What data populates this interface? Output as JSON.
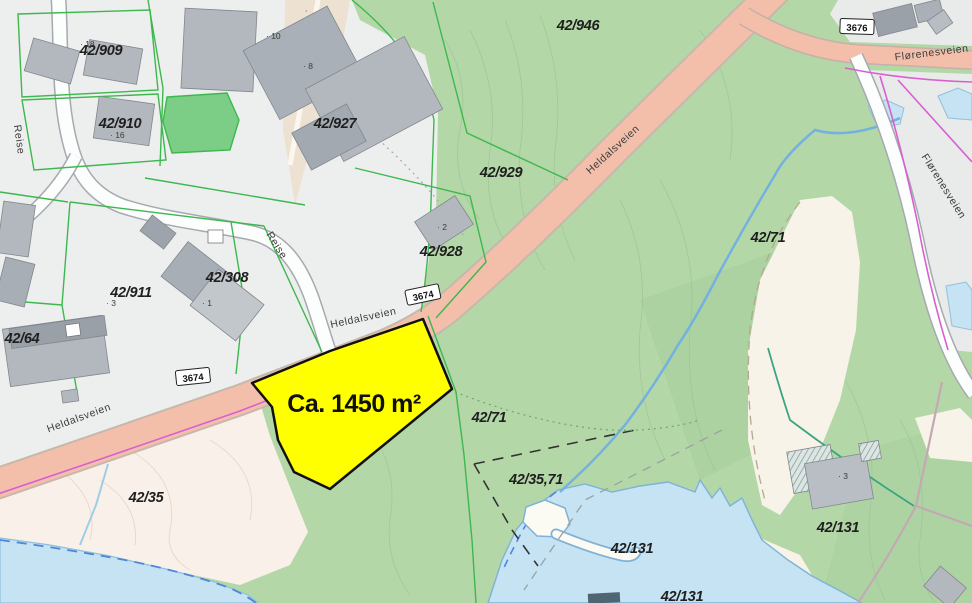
{
  "map": {
    "highlight": {
      "label": "Ca. 1450 m²",
      "color": "#ffff00"
    },
    "parcel_labels": [
      {
        "text": "42/909",
        "x": 101,
        "y": 55,
        "rot": 0
      },
      {
        "text": "42/910",
        "x": 120,
        "y": 128,
        "rot": 0
      },
      {
        "text": "42/927",
        "x": 335,
        "y": 128,
        "rot": 0
      },
      {
        "text": "42/946",
        "x": 578,
        "y": 30,
        "rot": 0
      },
      {
        "text": "42/929",
        "x": 501,
        "y": 177,
        "rot": 0
      },
      {
        "text": "42/928",
        "x": 441,
        "y": 256,
        "rot": 0
      },
      {
        "text": "42/308",
        "x": 227,
        "y": 282,
        "rot": 0
      },
      {
        "text": "42/911",
        "x": 131,
        "y": 297,
        "rot": 0
      },
      {
        "text": "42/64",
        "x": 22,
        "y": 343,
        "rot": 0
      },
      {
        "text": "42/71",
        "x": 768,
        "y": 242,
        "rot": 0
      },
      {
        "text": "42/71",
        "x": 489,
        "y": 422,
        "rot": 0
      },
      {
        "text": "42/35",
        "x": 146,
        "y": 502,
        "rot": 0
      },
      {
        "text": "42/35,71",
        "x": 536,
        "y": 484,
        "rot": 0
      },
      {
        "text": "42/131",
        "x": 632,
        "y": 553,
        "rot": 0
      },
      {
        "text": "42/131",
        "x": 682,
        "y": 601,
        "rot": 0
      },
      {
        "text": "42/131",
        "x": 838,
        "y": 532,
        "rot": 0
      }
    ],
    "road_labels": [
      {
        "text": "Heldalsveien",
        "x": 615,
        "y": 152,
        "rot": -42,
        "size": 10.5
      },
      {
        "text": "Heldalsveien",
        "x": 364,
        "y": 321,
        "rot": -12,
        "size": 10.5
      },
      {
        "text": "Heldalsveien",
        "x": 80,
        "y": 421,
        "rot": -20,
        "size": 10.5
      },
      {
        "text": "Flørenesveien",
        "x": 932,
        "y": 56,
        "rot": -7,
        "size": 10
      },
      {
        "text": "Flørenesveien",
        "x": 941,
        "y": 188,
        "rot": 58,
        "size": 10
      },
      {
        "text": "Reise",
        "x": 16,
        "y": 140,
        "rot": 82,
        "size": 9.5
      },
      {
        "text": "Reise",
        "x": 274,
        "y": 247,
        "rot": 58,
        "size": 9.5
      }
    ],
    "road_badges": [
      {
        "text": "3674",
        "x": 423,
        "y": 295,
        "rot": -12
      },
      {
        "text": "3674",
        "x": 193,
        "y": 377,
        "rot": -6
      },
      {
        "text": "3676",
        "x": 857,
        "y": 27,
        "rot": 2
      }
    ],
    "house_numbers": [
      {
        "text": "· 18",
        "x": 80,
        "y": 47
      },
      {
        "text": "· 16",
        "x": 110,
        "y": 138
      },
      {
        "text": "· 10",
        "x": 266,
        "y": 39
      },
      {
        "text": "· 8",
        "x": 303,
        "y": 69
      },
      {
        "text": "· 2",
        "x": 437,
        "y": 230
      },
      {
        "text": "· 3",
        "x": 106,
        "y": 306
      },
      {
        "text": "· 1",
        "x": 202,
        "y": 306
      },
      {
        "text": "· 3",
        "x": 838,
        "y": 479
      }
    ],
    "colors": {
      "highlight_yellow": "#ffff00",
      "forest_green": "#b4d7a8",
      "open_land_beige": "#faf0ea",
      "field_cream": "#f7f3e8",
      "road_salmon": "#f3bfab",
      "water_blue": "#c5e3f2",
      "parcel_line_green": "#3db84e",
      "boundary_magenta": "#d95fd0",
      "building_gray": "#b3b8be",
      "urban_gray": "#edefee"
    }
  }
}
